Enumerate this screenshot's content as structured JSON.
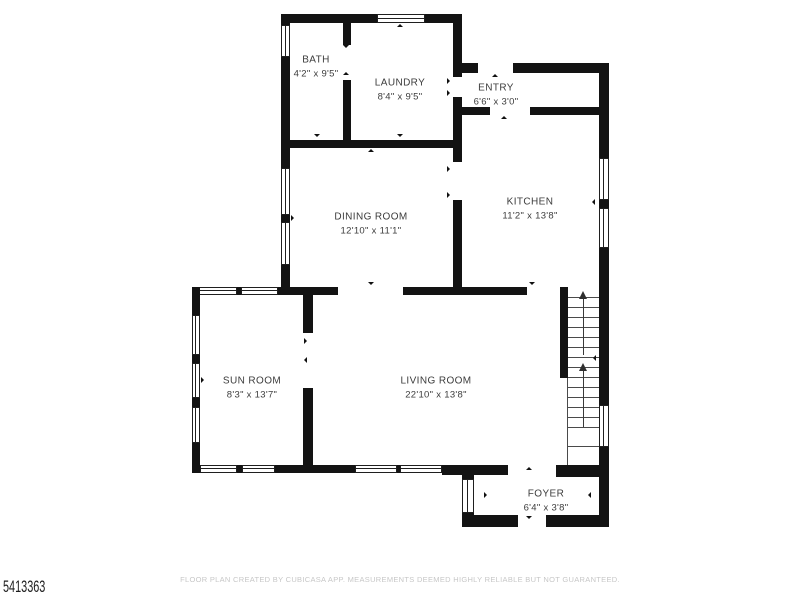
{
  "floor_plan": {
    "wall_color": "#131313",
    "label_color": "#3c3c3c",
    "rooms": {
      "bath": {
        "name": "BATH",
        "dimensions": "4'2\" x 9'5\""
      },
      "laundry": {
        "name": "LAUNDRY",
        "dimensions": "8'4\" x 9'5\""
      },
      "entry": {
        "name": "ENTRY",
        "dimensions": "6'6\" x 3'0\""
      },
      "dining_room": {
        "name": "DINING ROOM",
        "dimensions": "12'10\" x 11'1\""
      },
      "kitchen": {
        "name": "KITCHEN",
        "dimensions": "11'2\" x 13'8\""
      },
      "sun_room": {
        "name": "SUN ROOM",
        "dimensions": "8'3\" x 13'7\""
      },
      "living_room": {
        "name": "LIVING ROOM",
        "dimensions": "22'10\" x 13'8\""
      },
      "foyer": {
        "name": "FOYER",
        "dimensions": "6'4\" x 3'8\""
      }
    },
    "staircase": {
      "direction": "up"
    }
  },
  "footer": {
    "listing_id": "5413363",
    "disclaimer": "FLOOR PLAN CREATED BY CUBICASA APP. MEASUREMENTS DEEMED HIGHLY RELIABLE BUT NOT GUARANTEED."
  }
}
